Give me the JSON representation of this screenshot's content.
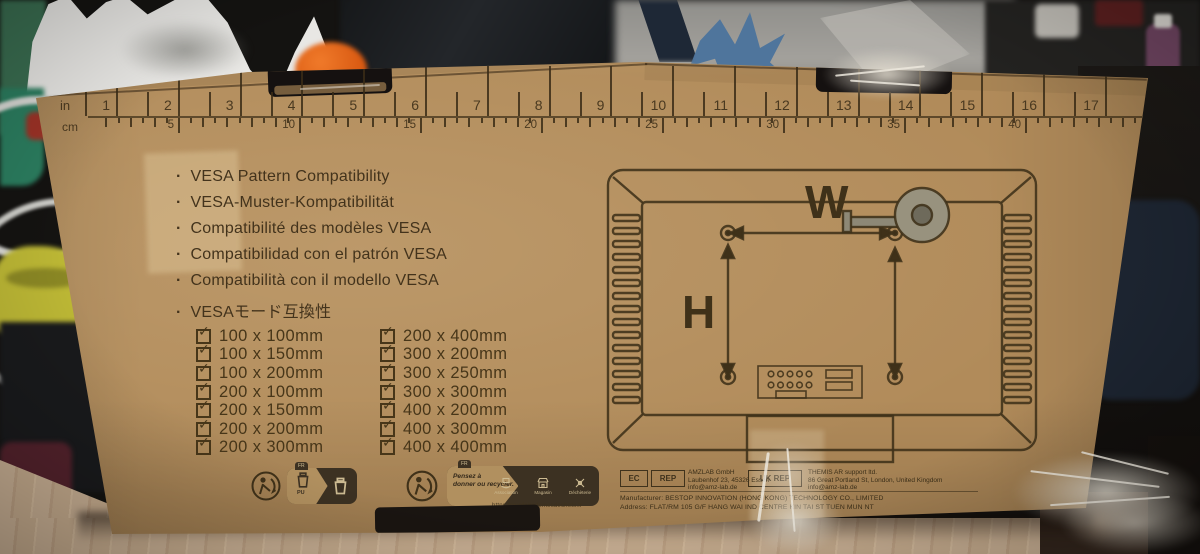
{
  "colors": {
    "cardboard": "#b18b5a",
    "print_ink": "#3f3119"
  },
  "icons": {
    "check": "✓",
    "bullet": "·"
  },
  "ruler": {
    "inch_label": "in",
    "cm_label": "cm",
    "inch_marks": [
      1,
      2,
      3,
      4,
      5,
      6,
      7,
      8,
      9,
      10,
      11,
      12,
      13,
      14,
      15,
      16,
      17
    ],
    "cm_marks": [
      5,
      10,
      15,
      20,
      25,
      30,
      35,
      40
    ]
  },
  "languages": [
    "VESA Pattern Compatibility",
    "VESA-Muster-Kompatibilität",
    "Compatibilité des modèles VESA",
    "Compatibilidad con el patrón VESA",
    "Compatibilità con il modello VESA",
    "VESAモード互換性"
  ],
  "vesa_sizes": {
    "column1": [
      "100 x 100mm",
      "100 x 150mm",
      "100 x 200mm",
      "200 x 100mm",
      "200 x 150mm",
      "200 x 200mm",
      "200 x 300mm"
    ],
    "column2": [
      "200 x 400mm",
      "300 x 200mm",
      "300 x 250mm",
      "300 x 300mm",
      "400 x 200mm",
      "400 x 300mm",
      "400 x 400mm"
    ]
  },
  "diagram": {
    "width_label": "W",
    "height_label": "H"
  },
  "footer": {
    "recycling": {
      "fr_tag": "FR",
      "pu_label": "PU",
      "donate_line1": "Pensez à",
      "donate_line2": "donner ou recycler.",
      "channels": [
        "Association",
        "Magasin",
        "Déchèterie"
      ],
      "url": "https://quefairedemesdechets.fr"
    },
    "ec_rep": {
      "box1": "EC",
      "box2": "REP",
      "lines": [
        "AMZLAB GmbH",
        "Laubenhof 23, 45326 Essen",
        "info@amz-lab.de"
      ]
    },
    "uk_rep": {
      "box": "UK REP",
      "lines": [
        "THEMIS AR support ltd.",
        "86 Great Portland St, London, United Kingdom",
        "info@amz-lab.de"
      ]
    },
    "manufacturer": "Manufacturer: BESTOP INNOVATION (HONG KONG) TECHNOLOGY CO., LIMITED",
    "address": "Address: FLAT/RM 105 G/F HANG WAI IND CENTRE KIN TAI ST TUEN MUN NT"
  }
}
